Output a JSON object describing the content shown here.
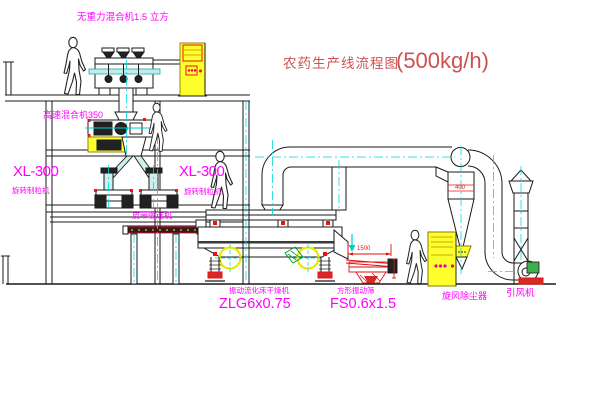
{
  "title": {
    "text": "农药生产线流程图",
    "capacity": "(500kg/h)"
  },
  "labels": {
    "gravity_mixer": "无重力混合机1.5 立方",
    "high_speed_mixer": "高速混合机350",
    "granulator_left_model": "XL-300",
    "granulator_left_name": "旋转制粒机",
    "granulator_right_model": "XL-300",
    "granulator_right_name": "旋转制粒机",
    "belt_conveyor": "皮带输送机",
    "dryer_name": "振动流化床干燥机",
    "dryer_model": "ZLG6x0.75",
    "sieve_name": "方形振动筛",
    "sieve_model": "FS0.6x1.5",
    "cyclone": "旋风除尘器",
    "induced_fan": "引风机"
  },
  "dimensions": {
    "sieve_length": "1500",
    "cyclone_band": "400"
  },
  "colors": {
    "label_magenta": "#ff00ff",
    "title_red": "#cc5252",
    "accent_red": "#ee1111",
    "highlight_yellow": "#ffff2e",
    "centerline_cyan": "#00d9d9",
    "line_black": "#1a1a1a",
    "green": "#00a33a"
  }
}
